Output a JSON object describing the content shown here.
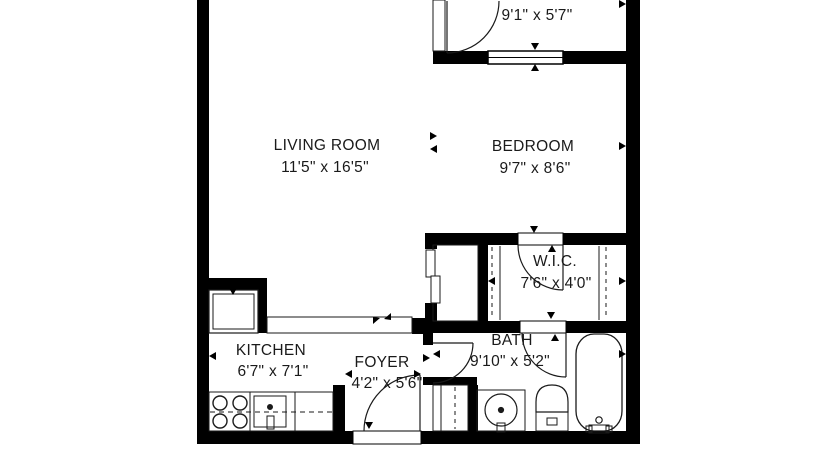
{
  "colors": {
    "background": "#ffffff",
    "walls": "#000000",
    "lines": "#1a1a1a",
    "text": "#1a1a1a"
  },
  "rooms": {
    "living_room": {
      "name": "LIVING ROOM",
      "dims": "11'5\" x 16'5\""
    },
    "bedroom": {
      "name": "BEDROOM",
      "dims": "9'7\" x 8'6\""
    },
    "upper_room": {
      "dims": "9'1\" x 5'7\""
    },
    "wic": {
      "name": "W.I.C.",
      "dims": "7'6\" x 4'0\""
    },
    "bath": {
      "name": "BATH",
      "dims": "9'10\" x 5'2\""
    },
    "kitchen": {
      "name": "KITCHEN",
      "dims": "6'7\" x 7'1\""
    },
    "foyer": {
      "name": "FOYER",
      "dims": "4'2\" x 5'6\""
    }
  },
  "fixtures": {
    "kitchen": [
      "refrigerator",
      "range-burners",
      "kitchen-sink",
      "counter-peninsula",
      "base-counter"
    ],
    "bath": [
      "vanity-sink",
      "toilet",
      "bathtub",
      "linen-closet"
    ],
    "closets": [
      "walk-in-closet-rods",
      "entry-closet",
      "foyer-closet"
    ],
    "openings": [
      "entry-door",
      "bath-door-foyer",
      "bath-door-wic",
      "wic-door",
      "upper-room-door",
      "window"
    ]
  }
}
